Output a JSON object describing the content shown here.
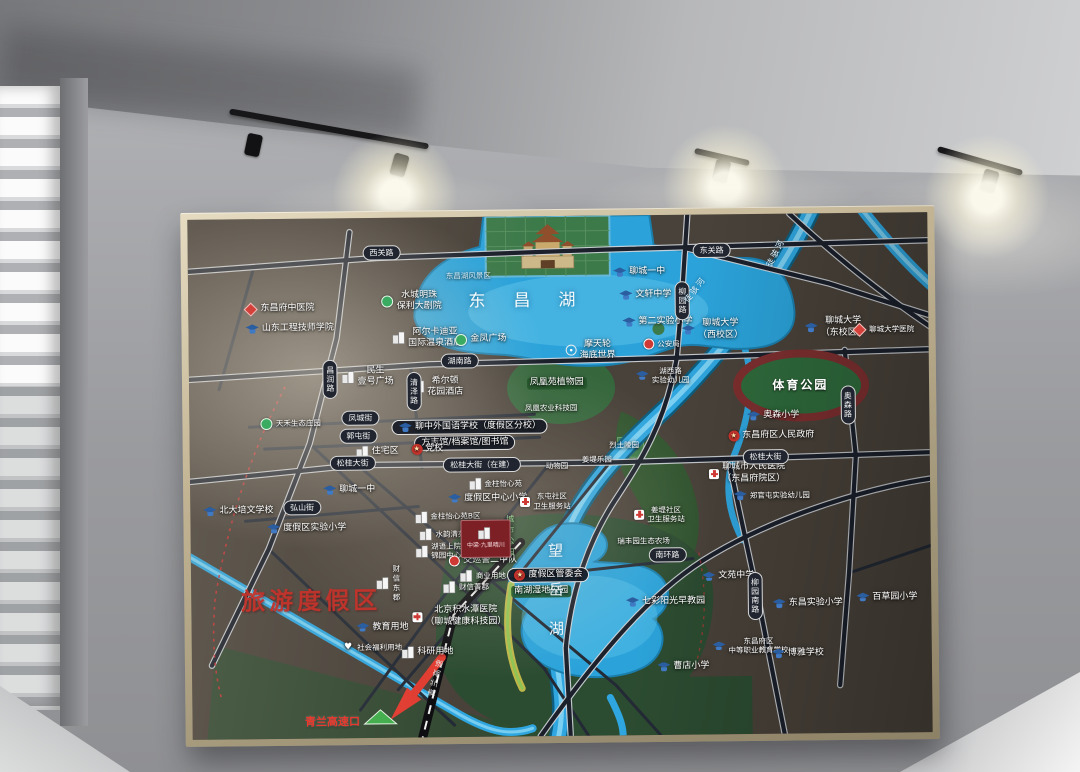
{
  "palette": {
    "board_frame": "#bfae8c",
    "map_bg": "#49423a",
    "water": "#2ba3da",
    "park_green": "#376b3e",
    "accent_red": "#c8342c",
    "road_dark": "#1b202b"
  },
  "map": {
    "region_title": "旅游度假区",
    "lakes": {
      "dongchang": "东昌湖",
      "wangyue": "望岳湖"
    },
    "sports_park": "体育公园",
    "city_park_vertical": "城市公园",
    "highway": {
      "name": "青兰高速",
      "exit_label": "青兰高速口"
    },
    "project": {
      "label": "中梁·九里晴川"
    },
    "rivers": [
      {
        "label": "徒骇河",
        "x": 79.5,
        "y": 7.5,
        "angle": -62
      },
      {
        "label": "徒骇河",
        "x": 68.5,
        "y": 14.5,
        "angle": -52
      }
    ],
    "road_labels": [
      {
        "label": "西关路",
        "x": 26.2,
        "y": 6.8
      },
      {
        "label": "东关路",
        "x": 70.8,
        "y": 6.9
      },
      {
        "label": "湖南路",
        "x": 36.6,
        "y": 27.6
      },
      {
        "label": "凤城街",
        "x": 23.1,
        "y": 38.4
      },
      {
        "label": "郭屯街",
        "x": 22.8,
        "y": 42.0
      },
      {
        "label": "松桂大街",
        "x": 22.0,
        "y": 47.2
      },
      {
        "label": "松桂大街（在建）",
        "x": 39.5,
        "y": 47.6
      },
      {
        "label": "松桂大街",
        "x": 77.8,
        "y": 46.8
      },
      {
        "label": "弘山街",
        "x": 15.1,
        "y": 55.6
      },
      {
        "label": "南环路",
        "x": 64.4,
        "y": 65.4
      },
      {
        "label": "昌润路",
        "x": 19.1,
        "y": 31.0,
        "vert": true
      },
      {
        "label": "清泽路",
        "x": 30.4,
        "y": 33.5,
        "vert": true
      },
      {
        "label": "柳园路",
        "x": 66.8,
        "y": 16.5,
        "vert": true
      },
      {
        "label": "奥森路",
        "x": 89.0,
        "y": 37.0,
        "vert": true
      },
      {
        "label": "柳园南路",
        "x": 76.2,
        "y": 73.5,
        "vert": true
      }
    ],
    "places": [
      {
        "name": "dongchangfu-tcm-hospital",
        "label": "东昌府中医院",
        "icon": "diamond",
        "x": 12.4,
        "y": 17.3
      },
      {
        "name": "shandong-engineering-college",
        "label": "山东工程技师学院",
        "icon": "school",
        "x": 13.7,
        "y": 21.2
      },
      {
        "name": "poly-grand-theater",
        "label": "水城明珠\n保利大剧院",
        "icon": "green",
        "x": 30.2,
        "y": 16.2
      },
      {
        "name": "arcadia-hot-spring-hotel",
        "label": "阿尔卡迪亚\n国际温泉酒店",
        "icon": "building",
        "x": 32.3,
        "y": 23.2
      },
      {
        "name": "jinfeng-plaza",
        "label": "金凤广场",
        "icon": "green",
        "x": 39.5,
        "y": 23.6
      },
      {
        "name": "minsheng-no1-plaza",
        "label": "民生\n壹号广场",
        "icon": "building",
        "x": 24.2,
        "y": 30.6
      },
      {
        "name": "hilton-garden-inn",
        "label": "希尔顿\n花园酒店",
        "icon": "building",
        "x": 33.6,
        "y": 32.6
      },
      {
        "name": "scenic-area-label",
        "label": "东昌湖风景区",
        "cls": "faint",
        "x": 37.9,
        "y": 11.4
      },
      {
        "name": "fenghuangyuan-botanical-garden",
        "label": "凤凰苑植物园",
        "cls": "greenpill",
        "x": 49.7,
        "y": 32.2
      },
      {
        "name": "fenghuang-agritech-park",
        "label": "凤凰农业科技园",
        "cls": "tiny",
        "x": 48.9,
        "y": 37.0
      },
      {
        "name": "liaozhong-foreign-language-school",
        "label": "聊中外国语学校（度假区分校）",
        "icon": "school",
        "pill": true,
        "x": 37.9,
        "y": 40.4
      },
      {
        "name": "archives-library",
        "label": "方志馆/档案馆/图书馆",
        "pill": true,
        "x": 37.2,
        "y": 43.4
      },
      {
        "name": "party-school",
        "label": "党校",
        "icon": "gov",
        "x": 32.1,
        "y": 44.6
      },
      {
        "name": "residential-area",
        "label": "住宅区",
        "icon": "building",
        "x": 25.4,
        "y": 45.0
      },
      {
        "name": "liaocheng-no1-middle-west",
        "label": "聊城一中",
        "icon": "school",
        "x": 21.5,
        "y": 52.3
      },
      {
        "name": "tianhe-eco-manor",
        "label": "天禾生态庄园",
        "icon": "green",
        "cls": "tiny",
        "x": 13.7,
        "y": 39.4
      },
      {
        "name": "peiwen-school",
        "label": "北大培文学校",
        "icon": "school",
        "x": 6.5,
        "y": 56.2
      },
      {
        "name": "resort-experimental-primary",
        "label": "度假区实验小学",
        "icon": "school",
        "x": 15.7,
        "y": 59.6
      },
      {
        "name": "resort-central-primary",
        "label": "度假区中心小学",
        "icon": "school",
        "x": 40.2,
        "y": 54.2
      },
      {
        "name": "jinzhu-yixinyuan",
        "label": "金柱怡心苑",
        "icon": "building",
        "cls": "tiny",
        "x": 41.3,
        "y": 51.4
      },
      {
        "name": "jinzhu-yixinyuan-b",
        "label": "金柱怡心苑B区",
        "icon": "building",
        "cls": "tiny",
        "x": 34.8,
        "y": 57.6
      },
      {
        "name": "shuiyun-qingyuan",
        "label": "水韵清苑",
        "icon": "building",
        "cls": "tiny",
        "x": 34.1,
        "y": 61.0
      },
      {
        "name": "huyu-shangyuan",
        "label": "湖语上院\n锦园中心",
        "icon": "building",
        "cls": "tiny",
        "x": 33.5,
        "y": 64.2
      },
      {
        "name": "traffic-police-squad",
        "label": "交巡警二中队",
        "icon": "police",
        "x": 39.5,
        "y": 66.2
      },
      {
        "name": "commercial-land",
        "label": "商业用地",
        "icon": "building",
        "cls": "tiny",
        "x": 39.5,
        "y": 69.0
      },
      {
        "name": "caixin-dongjun",
        "label": "财信东郡",
        "icon": "building",
        "vert": true,
        "cls": "tiny",
        "x": 26.7,
        "y": 70.3
      },
      {
        "name": "caixin-jingjun",
        "label": "财信菁郡",
        "icon": "building",
        "cls": "tiny",
        "x": 37.2,
        "y": 71.2
      },
      {
        "name": "jishuitan-hospital",
        "label": "北京积水潭医院\n（聊城健康科技园）",
        "icon": "hospital",
        "x": 36.2,
        "y": 76.8
      },
      {
        "name": "education-land",
        "label": "教育用地",
        "icon": "school",
        "x": 25.8,
        "y": 78.8
      },
      {
        "name": "social-welfare-land",
        "label": "社会福利用地",
        "icon": "heart",
        "cls": "tiny",
        "x": 24.5,
        "y": 82.7
      },
      {
        "name": "research-land",
        "label": "科研用地",
        "icon": "building",
        "x": 31.9,
        "y": 83.7
      },
      {
        "name": "resort-management-committee",
        "label": "度假区管委会",
        "icon": "star",
        "pill": true,
        "x": 48.3,
        "y": 69.0
      },
      {
        "name": "nanhu-wetland-park",
        "label": "南湖湿地公园",
        "cls": "greenpill",
        "x": 47.3,
        "y": 72.2
      },
      {
        "name": "qicai-sunshine-early-edu",
        "label": "七彩阳光早教园",
        "icon": "school",
        "x": 64.1,
        "y": 74.4
      },
      {
        "name": "caodian-primary",
        "label": "曹店小学",
        "icon": "school",
        "x": 66.4,
        "y": 86.9
      },
      {
        "name": "ruifengyuan-eco-farm",
        "label": "瑞丰园生态农场",
        "cls": "tiny",
        "x": 61.2,
        "y": 62.7
      },
      {
        "name": "dongtun-community-clinic",
        "label": "东屯社区\n卫生服务站",
        "icon": "hospital",
        "cls": "tiny",
        "x": 48.0,
        "y": 54.9
      },
      {
        "name": "jiangdi-community-clinic",
        "label": "姜堤社区\n卫生服务站",
        "icon": "hospital",
        "cls": "tiny",
        "x": 63.4,
        "y": 57.6
      },
      {
        "name": "jiangdi-amusement-park",
        "label": "姜堤乐园",
        "cls": "tiny",
        "x": 55.0,
        "y": 47.0
      },
      {
        "name": "zoo",
        "label": "动物园",
        "cls": "tiny",
        "x": 49.6,
        "y": 48.0
      },
      {
        "name": "martyrs-cemetery",
        "label": "烈士陵园",
        "cls": "tiny",
        "x": 58.7,
        "y": 44.2
      },
      {
        "name": "huxilu-experimental-kindergarten",
        "label": "湖西路\n实验幼儿园",
        "icon": "school",
        "cls": "tiny",
        "x": 64.0,
        "y": 30.9
      },
      {
        "name": "liaocheng-no1-middle-north",
        "label": "聊城一中",
        "icon": "school",
        "x": 61.0,
        "y": 11.0
      },
      {
        "name": "wenxuan-middle-school",
        "label": "文轩中学",
        "icon": "school",
        "x": 61.8,
        "y": 15.4
      },
      {
        "name": "no2-experimental-primary",
        "label": "第二实验小学",
        "icon": "school",
        "x": 63.4,
        "y": 20.6
      },
      {
        "name": "public-security-bureau",
        "label": "公安局",
        "icon": "police",
        "cls": "tiny",
        "x": 63.9,
        "y": 24.9
      },
      {
        "name": "ferris-wheel-sea-world",
        "label": "摩天轮\n海底世界",
        "icon": "ferris",
        "x": 54.3,
        "y": 25.9
      },
      {
        "name": "liaocheng-university-west",
        "label": "聊城大学\n（西校区）",
        "icon": "school",
        "x": 70.8,
        "y": 22.2
      },
      {
        "name": "liaocheng-university-east",
        "label": "聊城大学\n（东校区）",
        "icon": "school",
        "x": 87.4,
        "y": 22.0
      },
      {
        "name": "liaocheng-university-hospital",
        "label": "聊城大学医院",
        "icon": "diamond",
        "cls": "tiny",
        "x": 94.0,
        "y": 22.5
      },
      {
        "name": "aosen-primary",
        "label": "奥森小学",
        "icon": "school",
        "x": 78.9,
        "y": 38.9
      },
      {
        "name": "district-peoples-government",
        "label": "东昌府区人民政府",
        "icon": "gov",
        "x": 78.6,
        "y": 42.7
      },
      {
        "name": "liaocheng-peoples-hospital",
        "label": "聊城市人民医院\n（东昌府院区）",
        "icon": "hospital",
        "x": 75.3,
        "y": 49.9
      },
      {
        "name": "zhengguantun-kindergarten",
        "label": "郑官屯实验幼儿园",
        "icon": "school",
        "cls": "tiny",
        "x": 78.6,
        "y": 54.2
      },
      {
        "name": "wenyuan-middle-school",
        "label": "文苑中学",
        "icon": "school",
        "x": 72.6,
        "y": 69.7
      },
      {
        "name": "dongchang-experimental-primary",
        "label": "东昌实验小学",
        "icon": "school",
        "x": 83.3,
        "y": 75.0
      },
      {
        "name": "baicaoyuan-primary",
        "label": "百草园小学",
        "icon": "school",
        "x": 94.0,
        "y": 74.0
      },
      {
        "name": "vocational-education-school",
        "label": "东昌府区\n中等职业教育学校",
        "icon": "school",
        "cls": "tiny",
        "x": 75.5,
        "y": 83.1
      },
      {
        "name": "boya-school",
        "label": "博雅学校",
        "icon": "school",
        "x": 81.9,
        "y": 84.6
      }
    ]
  }
}
